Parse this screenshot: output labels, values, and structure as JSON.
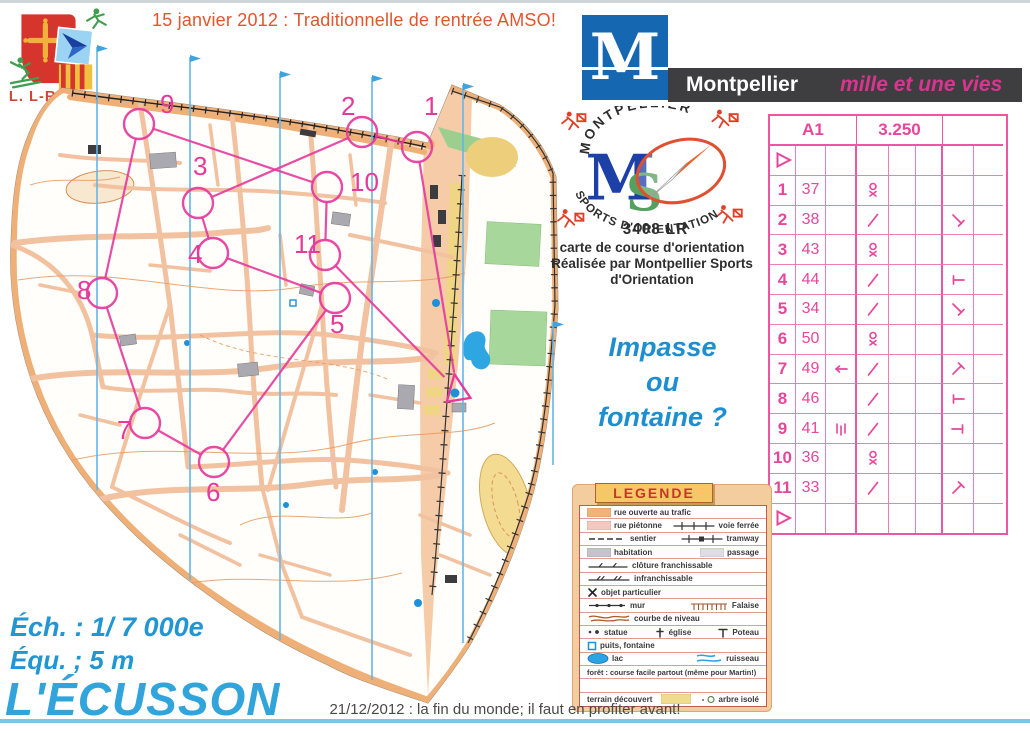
{
  "header": {
    "event_title": "15 janvier 2012 : Traditionnelle de rentrée AMSO!",
    "club_label": "L. L-R.C.O."
  },
  "montpellier_banner": {
    "letter": "M",
    "city": "Montpellier",
    "slogan": "mille et une vies"
  },
  "mso": {
    "arc_top": "MONTPELLIER",
    "letter_m": "M",
    "letter_s": "S",
    "arc_bottom": "SPORTS D'ORIENTATION",
    "code": "3408 LR",
    "caption": [
      "carte de course d'orientation",
      "Réalisée par Montpellier Sports",
      "d'Orientation"
    ]
  },
  "question": {
    "line1": "Impasse",
    "line2": "ou",
    "line3": "fontaine ?"
  },
  "map_info": {
    "scale": "Éch. : 1/ 7 000e",
    "equidistance": "Équ. ; 5 m",
    "name": "L'ÉCUSSON"
  },
  "footer": {
    "note": "21/12/2012 : la fin du monde; il faut en profiter avant!"
  },
  "course_card": {
    "course": "A1",
    "length": "3.250",
    "climb": "",
    "rows": [
      {
        "a": "start",
        "b": "",
        "c": "",
        "d": "",
        "g": ""
      },
      {
        "a": "1",
        "b": "37",
        "c": "",
        "d": "statue",
        "g": ""
      },
      {
        "a": "2",
        "b": "38",
        "c": "",
        "d": "slash",
        "g": "bar-se"
      },
      {
        "a": "3",
        "b": "43",
        "c": "",
        "d": "statue",
        "g": ""
      },
      {
        "a": "4",
        "b": "44",
        "c": "",
        "d": "slash",
        "g": "t-left"
      },
      {
        "a": "5",
        "b": "34",
        "c": "",
        "d": "slash",
        "g": "bar-se"
      },
      {
        "a": "6",
        "b": "50",
        "c": "",
        "d": "statue",
        "g": ""
      },
      {
        "a": "7",
        "b": "49",
        "c": "arrow-left",
        "d": "slash",
        "g": "bar-ne"
      },
      {
        "a": "8",
        "b": "46",
        "c": "",
        "d": "slash",
        "g": "t-left"
      },
      {
        "a": "9",
        "b": "41",
        "c": "between",
        "d": "slash",
        "g": "t-right"
      },
      {
        "a": "10",
        "b": "36",
        "c": "",
        "d": "statue",
        "g": ""
      },
      {
        "a": "11",
        "b": "33",
        "c": "",
        "d": "slash",
        "g": "bar-ne"
      },
      {
        "a": "finish",
        "b": "",
        "c": "",
        "d": "",
        "g": ""
      }
    ]
  },
  "map_course": {
    "start": {
      "x": 457,
      "y": 355
    },
    "controls": [
      {
        "n": "1",
        "x": 417,
        "y": 112,
        "lx": 424,
        "ly": 80
      },
      {
        "n": "2",
        "x": 362,
        "y": 97,
        "lx": 341,
        "ly": 80
      },
      {
        "n": "3",
        "x": 198,
        "y": 168,
        "lx": 193,
        "ly": 140
      },
      {
        "n": "4",
        "x": 213,
        "y": 218,
        "lx": 188,
        "ly": 228
      },
      {
        "n": "5",
        "x": 335,
        "y": 263,
        "lx": 330,
        "ly": 298
      },
      {
        "n": "6",
        "x": 214,
        "y": 427,
        "lx": 206,
        "ly": 466
      },
      {
        "n": "7",
        "x": 145,
        "y": 388,
        "lx": 117,
        "ly": 404
      },
      {
        "n": "8",
        "x": 102,
        "y": 258,
        "lx": 77,
        "ly": 264
      },
      {
        "n": "9",
        "x": 139,
        "y": 89,
        "lx": 160,
        "ly": 78
      },
      {
        "n": "10",
        "x": 327,
        "y": 152,
        "lx": 350,
        "ly": 156
      },
      {
        "n": "11",
        "x": 325,
        "y": 220,
        "lx": 294,
        "ly": 218
      }
    ]
  },
  "legend": {
    "title": "LEGENDE",
    "rows": [
      {
        "items": [
          {
            "sym": "swatch-orange",
            "label": "rue ouverte au trafic"
          }
        ]
      },
      {
        "items": [
          {
            "sym": "swatch-pink",
            "label": "rue piétonne"
          },
          {
            "sym": "railway",
            "label": "voie ferrée"
          }
        ]
      },
      {
        "items": [
          {
            "sym": "dashline",
            "label": "sentier"
          },
          {
            "sym": "tramway",
            "label": "tramway"
          }
        ]
      },
      {
        "items": [
          {
            "sym": "swatch-gray",
            "label": "habitation"
          },
          {
            "sym": "swatch-lightgray",
            "label": "passage"
          }
        ]
      },
      {
        "items": [
          {
            "sym": "fence1",
            "label": "clôture franchissable"
          }
        ]
      },
      {
        "items": [
          {
            "sym": "fence2",
            "label": "infranchissable"
          }
        ]
      },
      {
        "items": [
          {
            "sym": "crossx",
            "label": "objet particulier"
          }
        ]
      },
      {
        "items": [
          {
            "sym": "wall",
            "label": "mur"
          },
          {
            "sym": "cliff",
            "label": "Falaise"
          }
        ]
      },
      {
        "items": [
          {
            "sym": "contour",
            "label": "courbe de niveau"
          }
        ]
      },
      {
        "items": [
          {
            "sym": "statuedots",
            "label": "statue"
          },
          {
            "sym": "church",
            "label": "église"
          },
          {
            "sym": "pole",
            "label": "Poteau"
          }
        ]
      },
      {
        "items": [
          {
            "sym": "well",
            "label": "puits, fontaine"
          }
        ]
      },
      {
        "items": [
          {
            "sym": "lake",
            "label": "lac"
          },
          {
            "sym": "stream",
            "label": "ruisseau"
          }
        ]
      },
      {
        "items": [
          {
            "sym": "",
            "label": "forêt : course facile partout (même pour Martin!)"
          }
        ]
      },
      {
        "items": []
      },
      {
        "items": [
          {
            "sym": "",
            "label": "terrain découvert"
          },
          {
            "sym": "swatch-yellow",
            "label": ""
          },
          {
            "sym": "tree",
            "label": "arbre isolé"
          }
        ]
      }
    ]
  },
  "colors": {
    "course_magenta": "#E6399B",
    "card_pink": "#EE56A2",
    "north_line_blue": "#66B5E6",
    "street_salmon": "#F2C2A0",
    "boulevard_orange": "#EFB078",
    "title_orange": "#E2552F",
    "blue_text": "#2196D2",
    "slogan_magenta": "#D8368E"
  }
}
